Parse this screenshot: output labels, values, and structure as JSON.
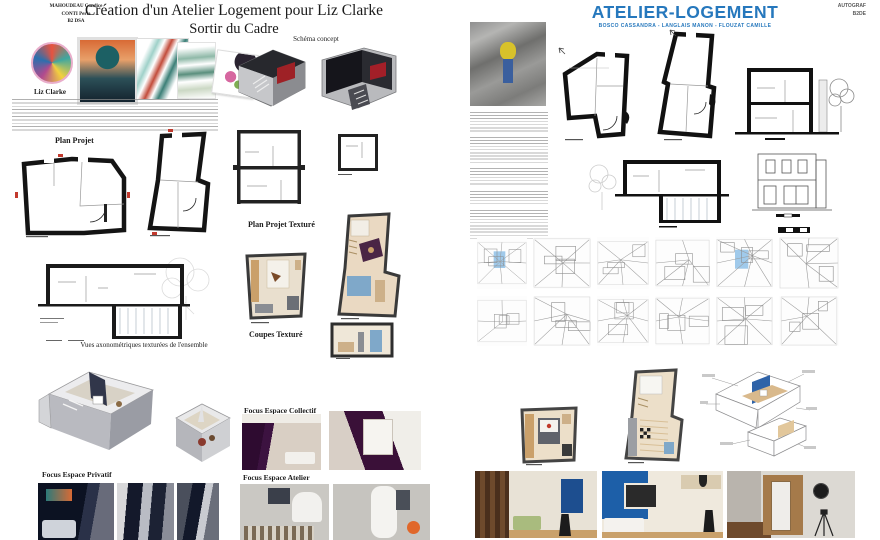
{
  "left_board": {
    "authors": {
      "line1": "MAHOUDEAU Candice",
      "line2": "CONTI Perla",
      "line3": "B2 DSA"
    },
    "title": "Création d'un Atelier Logement pour Liz Clarke",
    "subtitle": "Sortir du Cadre",
    "artist_name": "Liz Clarke",
    "labels": {
      "schema_concept": "Schéma concept",
      "plan_projet": "Plan Projet",
      "plan_projet_texture": "Plan Projet Texturé",
      "coupes_texture": "Coupes Texturé",
      "vues_axonometriques": "Vues axonométriques texturées de l'ensemble",
      "focus_privatif": "Focus Espace Privatif",
      "focus_collectif": "Focus Espace Collectif",
      "focus_atelier": "Focus Espace Atelier"
    }
  },
  "right_board": {
    "title": "ATELIER-LOGEMENT",
    "team": "BOSCO CASSANDRA - LANGLAIS MANON - FLOUZAT CAMILLE",
    "school": "AUTOGRAF",
    "class_code": "B2DE",
    "accent_color": "#2678bd"
  }
}
